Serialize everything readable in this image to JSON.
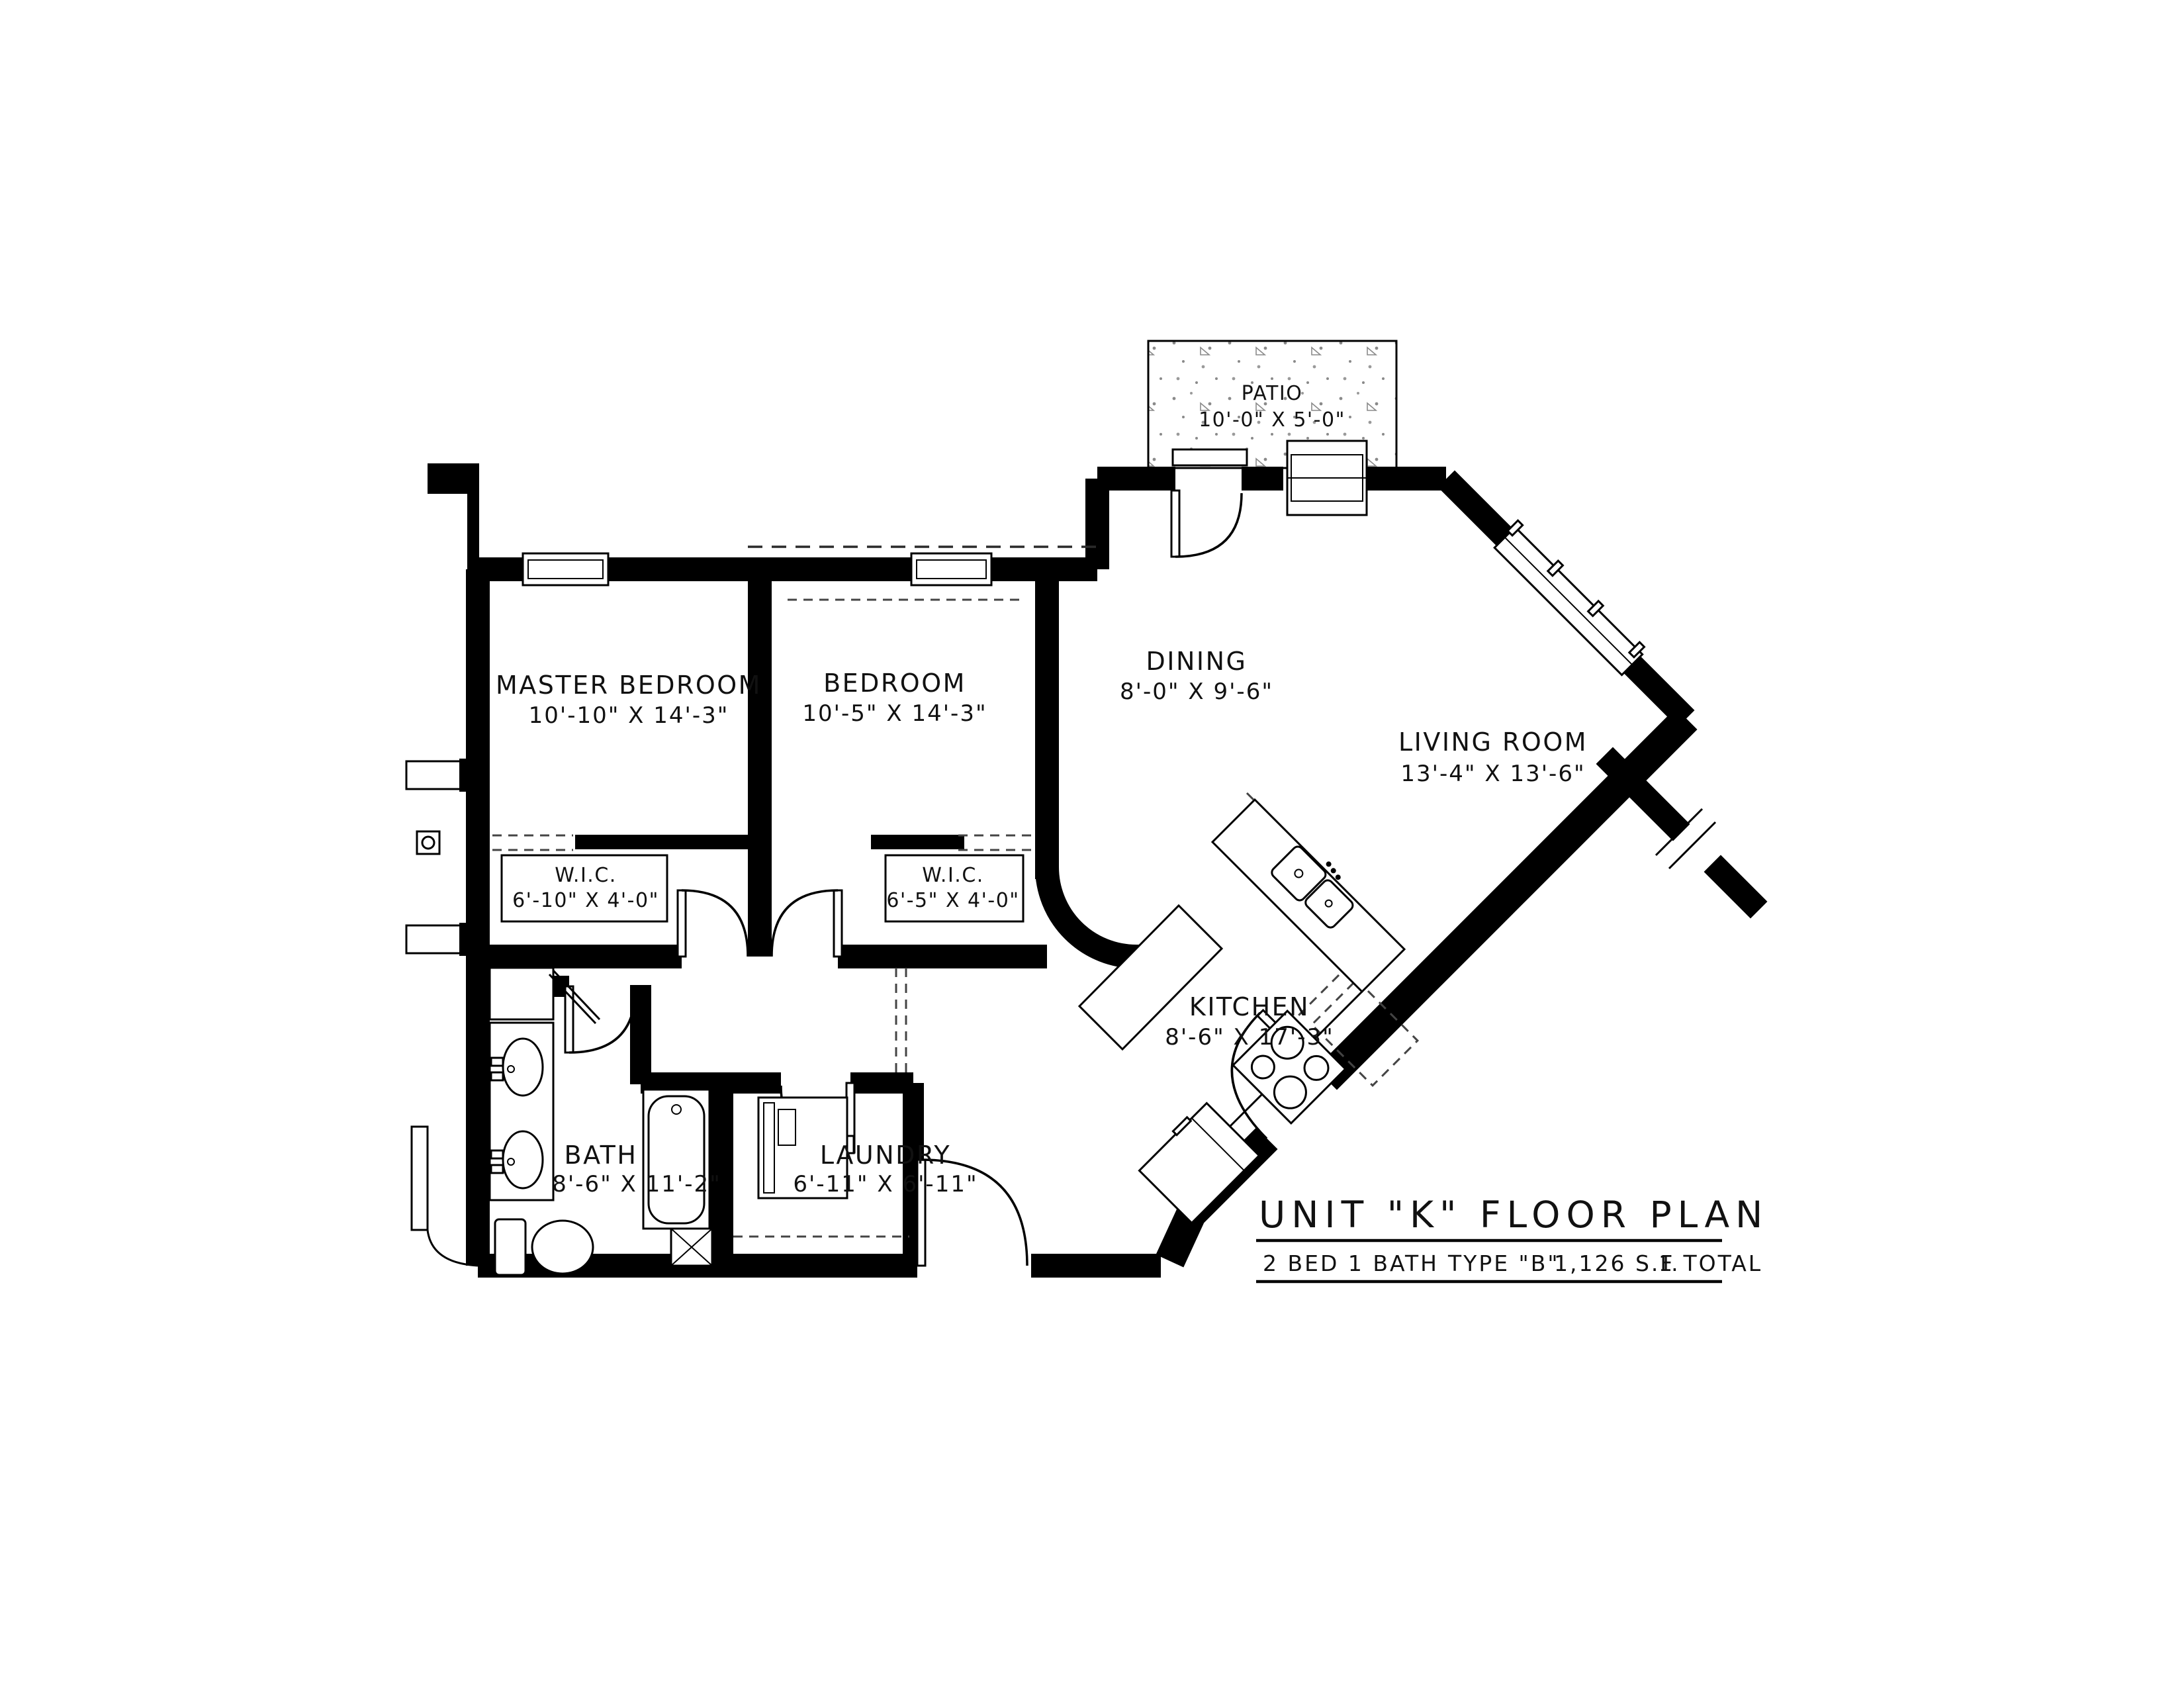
{
  "title_block": {
    "title": "UNIT \"K\" FLOOR PLAN",
    "beds_baths": "2 BED 1 BATH",
    "type": "TYPE \"B\"",
    "area": "1,126 S.F.",
    "total": "1 TOTAL"
  },
  "rooms": {
    "patio": {
      "name": "PATIO",
      "dims": "10'-0\" X 5'-0\""
    },
    "master_bedroom": {
      "name": "MASTER BEDROOM",
      "dims": "10'-10\" X 14'-3\""
    },
    "bedroom": {
      "name": "BEDROOM",
      "dims": "10'-5\" X 14'-3\""
    },
    "dining": {
      "name": "DINING",
      "dims": "8'-0\" X 9'-6\""
    },
    "living_room": {
      "name": "LIVING ROOM",
      "dims": "13'-4\" X 13'-6\""
    },
    "wic_master": {
      "name": "W.I.C.",
      "dims": "6'-10\" X 4'-0\""
    },
    "wic_bedroom": {
      "name": "W.I.C.",
      "dims": "6'-5\" X 4'-0\""
    },
    "kitchen": {
      "name": "KITCHEN",
      "dims": "8'-6\" X 17'-3\""
    },
    "bath": {
      "name": "BATH",
      "dims": "8'-6\" X 11'-2\""
    },
    "laundry": {
      "name": "LAUNDRY",
      "dims": "6'-11\" X 6'-11\""
    }
  },
  "colors": {
    "walls": "#000000",
    "background": "#ffffff",
    "stipple": "#8a8a8a"
  }
}
